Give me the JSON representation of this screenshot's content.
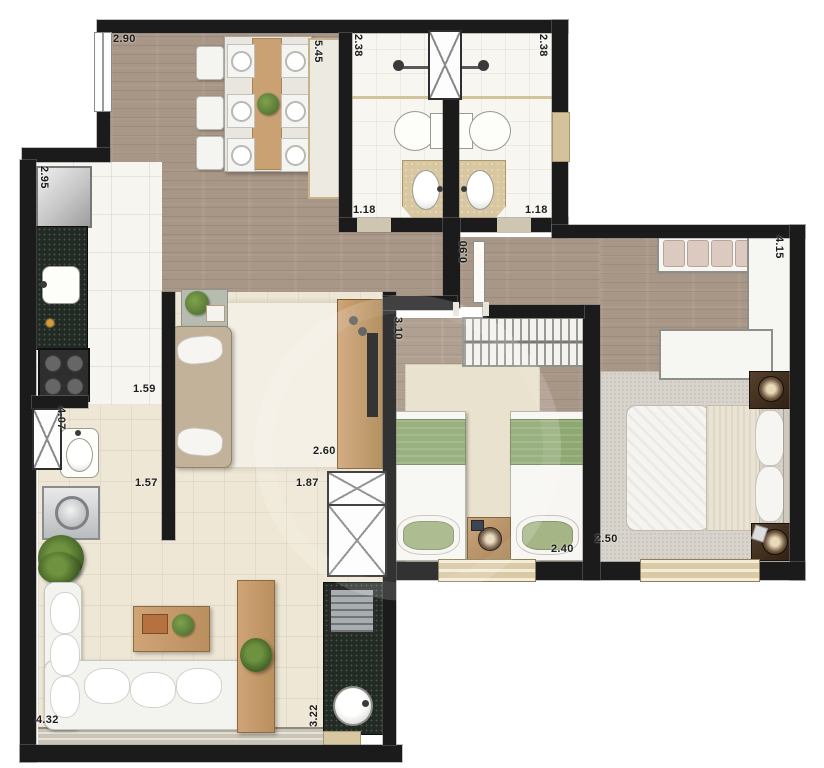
{
  "plan_title": "apartment-floor-plan",
  "dimensions": {
    "dining_width_top": "2.90",
    "social_area_depth": "5.45",
    "bath1_depth": "2.38",
    "bath2_depth": "2.38",
    "bath1_width": "1.18",
    "bath2_width": "1.18",
    "hall_passage_width": "0.90",
    "kitchen_depth": "2.95",
    "kitchen_width": "1.59",
    "service_area_depth": "4.07",
    "service_area_width": "1.57",
    "tv_room_width": "2.60",
    "tv_room_opening_width": "1.87",
    "twin_bedroom_depth": "3.10",
    "twin_bedroom_width": "2.40",
    "master_bedroom_depth": "2.50",
    "master_suite_width": "4.15",
    "living_room_width": "4.32",
    "living_terrace_depth": "3.22"
  },
  "colors": {
    "wall": "#1b1b1b",
    "wood_floor": "#a89686",
    "white_tile": "#f6f5f0",
    "beige_tile": "#efe7d5",
    "granite_counter": "#222a24",
    "bed_green": "#8ea872",
    "furniture_wood": "#c49a6c",
    "vanity_travertine": "#d8c7a0",
    "carpet_gray": "#d8d4cc",
    "window_sill_tan": "#d9c9a4"
  }
}
